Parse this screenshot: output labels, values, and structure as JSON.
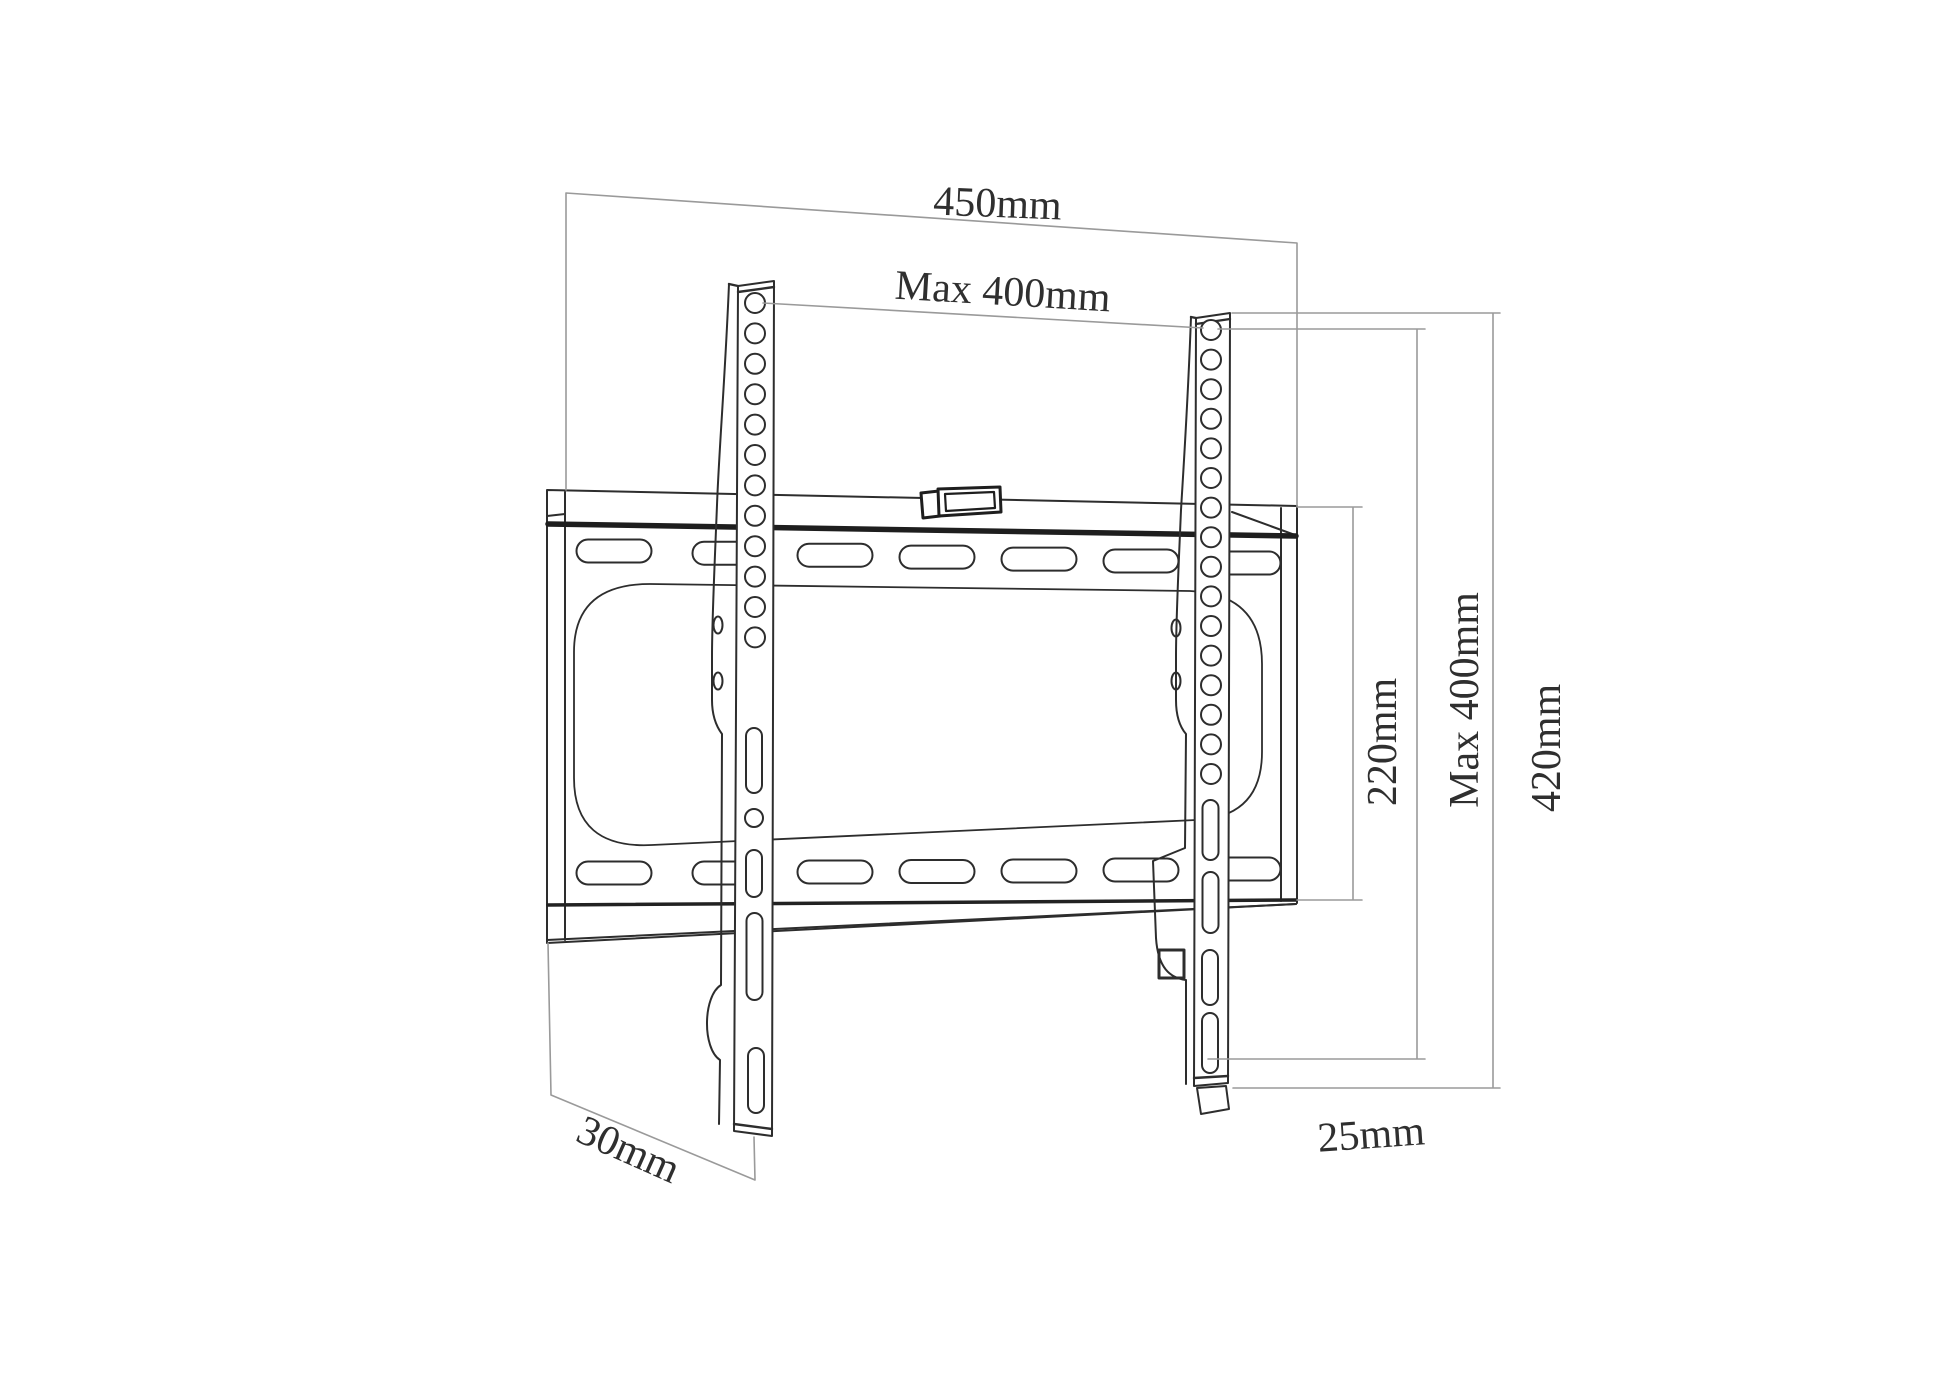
{
  "diagram": {
    "kind": "tv-wall-mount-technical-drawing",
    "units": "mm",
    "dimensions": {
      "top_width": "450mm",
      "vesa_max_width": "Max 400mm",
      "plate_height": "220mm",
      "vesa_max_height": "Max 400mm",
      "rail_height": "420mm",
      "bottom_offset": "25mm",
      "depth": "30mm"
    },
    "colors": {
      "background": "#ffffff",
      "outline": "#2d2d2d",
      "seam": "#1e1e1e",
      "dimension_line": "#9a9a9a",
      "label_text": "#2f2f2f"
    }
  }
}
